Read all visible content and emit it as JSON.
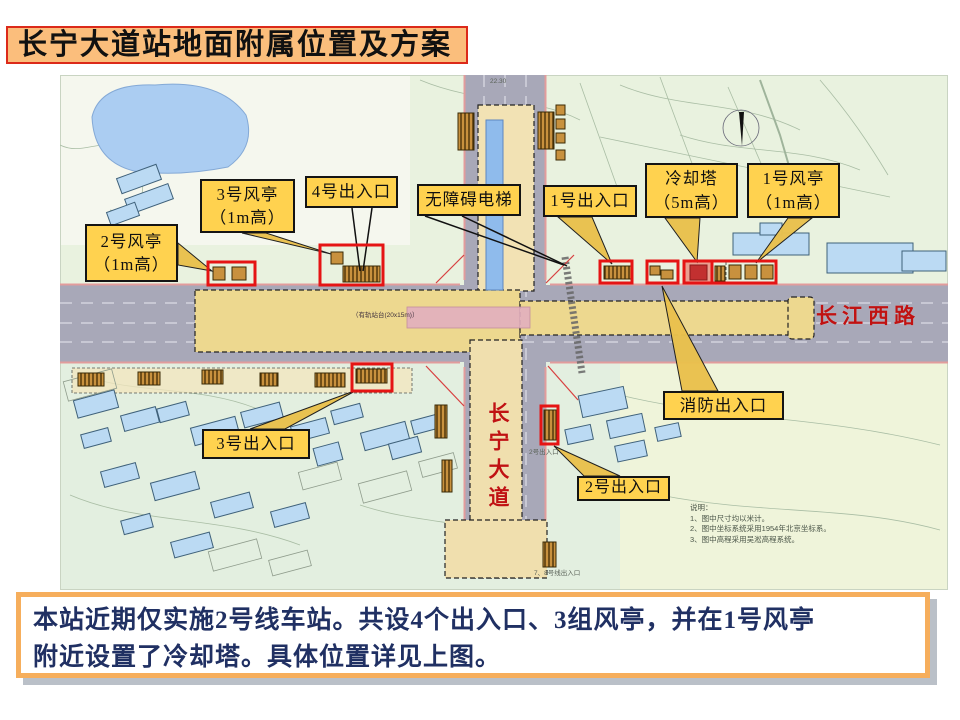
{
  "title": "长宁大道站地面附属位置及方案",
  "summary": {
    "line1": "本站近期仅实施2号线车站。共设4个出入口、3组风亭，并在1号风亭",
    "line2": "附近设置了冷却塔。具体位置详见上图。"
  },
  "map": {
    "road_names": {
      "east_west": "长江西路",
      "north_south": "长宁大道"
    },
    "platform_label": "（有轨站台(20x15m)）",
    "notes": {
      "heading": "说明：",
      "line1": "1、图中尺寸均以米计。",
      "line2": "2、图中坐标系统采用1954年北京坐标系。",
      "line3": "3、图中高程采用吴淞高程系统。"
    },
    "micro_labels": {
      "exit2_small": "2号出入口",
      "line78_exit": "7、8号线出入口",
      "dimension": "22.30"
    },
    "callouts": {
      "fengting2": {
        "line1": "2号风亭",
        "line2": "（1m高）"
      },
      "fengting3": {
        "line1": "3号风亭",
        "line2": "（1m高）"
      },
      "exit4": {
        "line1": "4号出入口"
      },
      "elevator": {
        "line1": "无障碍电梯"
      },
      "exit1": {
        "line1": "1号出入口"
      },
      "cooling": {
        "line1": "冷却塔",
        "line2": "（5m高）"
      },
      "fengting1": {
        "line1": "1号风亭",
        "line2": "（1m高）"
      },
      "fire": {
        "line1": "消防出入口"
      },
      "exit3": {
        "line1": "3号出入口"
      },
      "exit2": {
        "line1": "2号出入口"
      }
    },
    "colors": {
      "highlight_red": "#E51414",
      "callout_bg": "#FFD24F",
      "title_bg": "#FBBE7C",
      "title_border": "#DC2A1A",
      "summary_border": "#F6AE5C",
      "summary_text": "#203063",
      "road_gray": "#A8A8B8",
      "station_yellow": "#EDD88F",
      "building_blue": "#BBDAF3",
      "water_blue": "#9CC2EE",
      "road_name_red": "#C01212"
    }
  }
}
